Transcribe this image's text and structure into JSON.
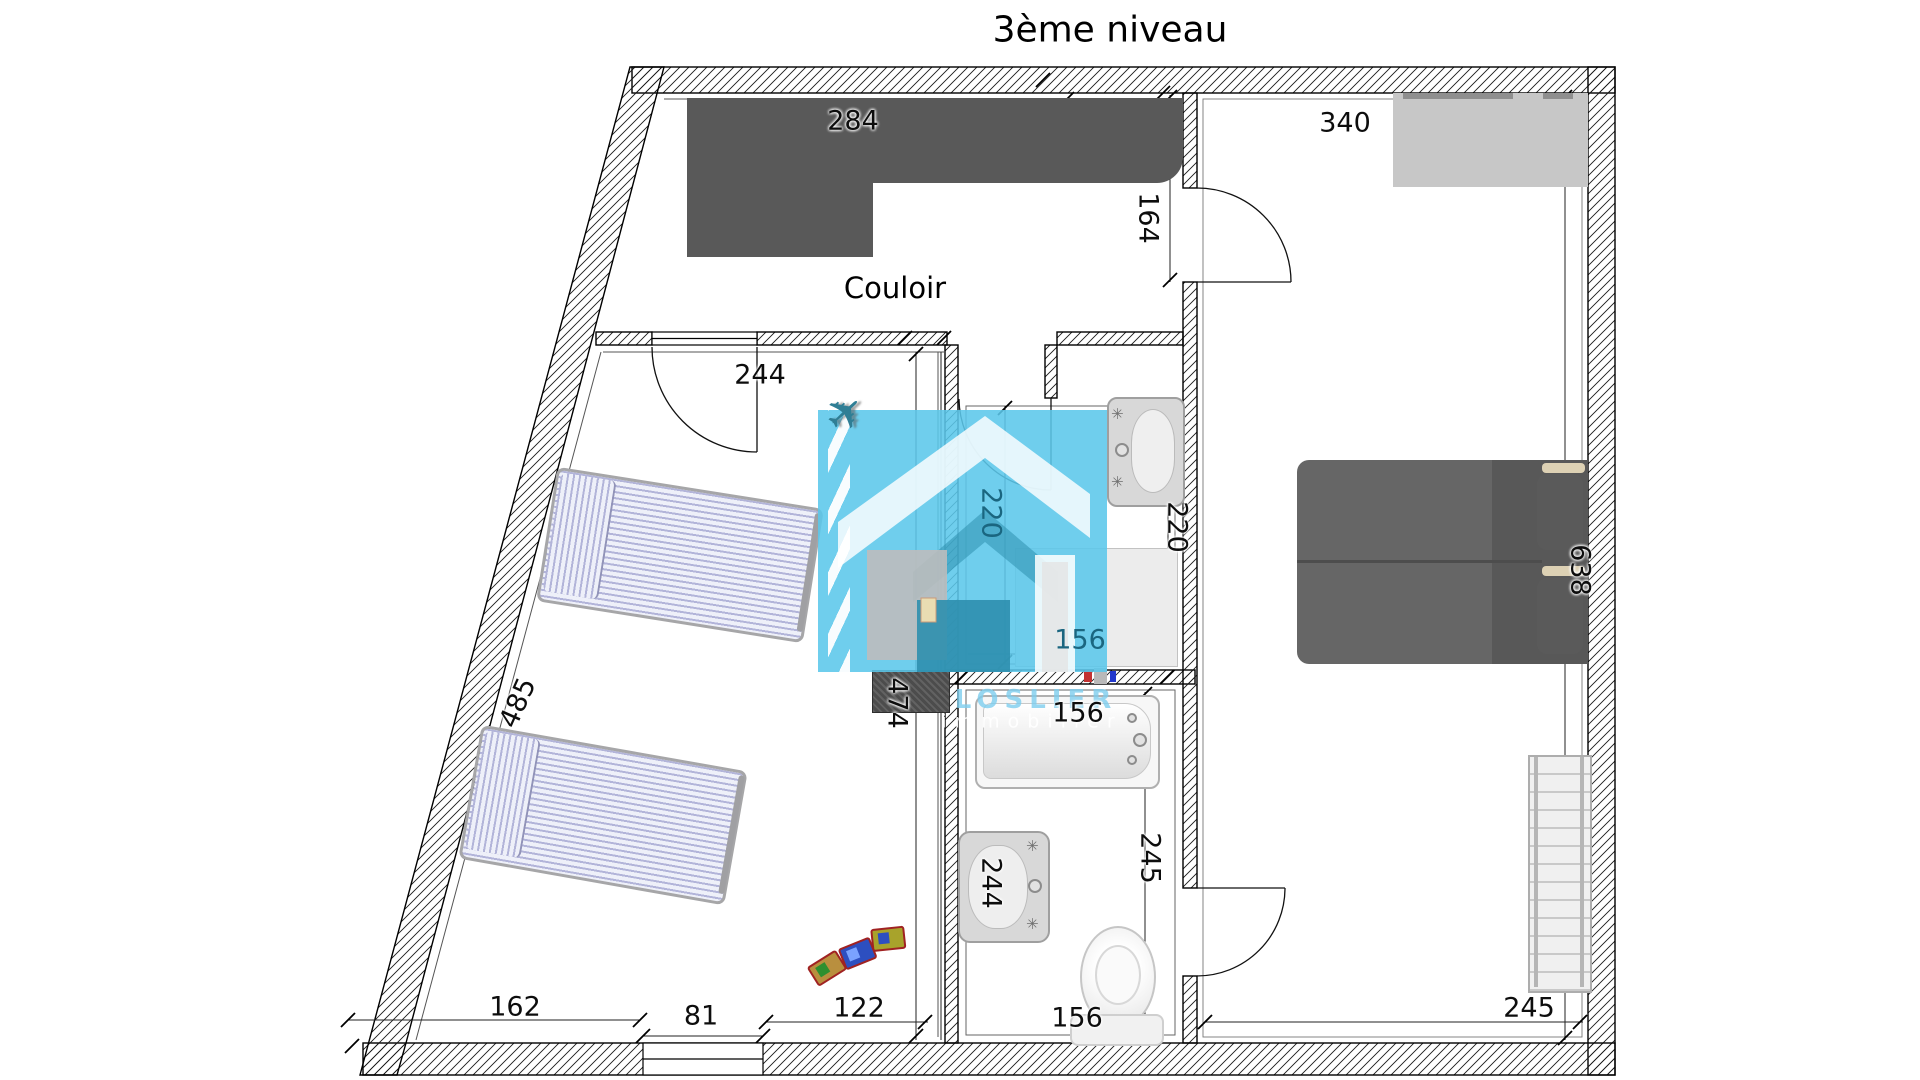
{
  "title": "3ème niveau",
  "corridor_label": "Couloir",
  "watermark": {
    "line1": "LOSLIER",
    "line2": "immobilier",
    "blue": "#5bc7ea",
    "teal_square": "#2e8fae"
  },
  "icons": {
    "plane": "✈",
    "faucet": "✳"
  },
  "colors": {
    "wardrobe_gray": "#595959",
    "closet_gray": "#c7c7c7",
    "bed_lavender": "#b2b4d9",
    "double_bed_gray": "#666666",
    "pillow_beige": "#ddd1b4",
    "dim_teal_text": "#1a6680"
  },
  "dims": {
    "wardrobe_w": "284",
    "bedroom2_w": "340",
    "entry_d": "164",
    "door1": "244",
    "bath1_w_in": "220",
    "bath1_w": "220",
    "bedroom2_h": "638",
    "wall_left": "485",
    "bath1_d": "156",
    "bedroom1_wall": "474",
    "tub_w": "156",
    "sink2": "244",
    "wc_h": "245",
    "wc_w": "156",
    "bottom_1": "162",
    "bottom_2": "81",
    "bottom_3": "122",
    "bedroom2_bottom": "245"
  }
}
